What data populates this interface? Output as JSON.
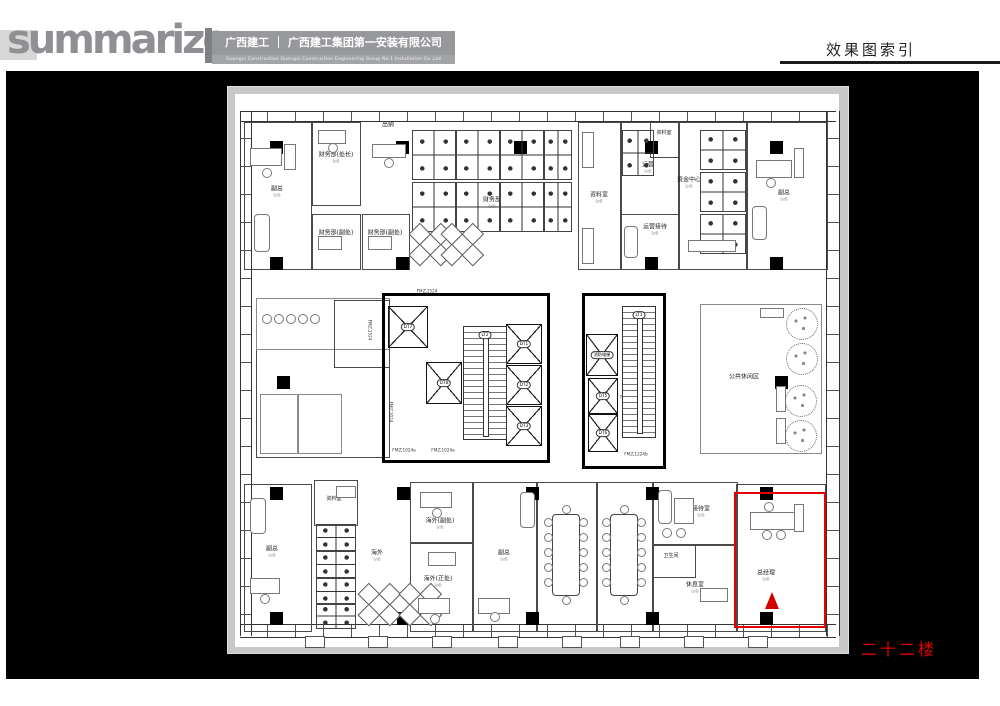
{
  "header": {
    "brand": "summarize",
    "company_cn": "广西建工 ｜ 广西建工集团第一安装有限公司",
    "company_en": "Guangxi Construction      Guangxi Construction Engineering Group No.1 Installation Co.,Ltd",
    "page_title": "效果图索引"
  },
  "footer": {
    "floor_label": "二十二楼"
  },
  "plan": {
    "area_suffix": "(㎡)",
    "highlight_color": "#e60000",
    "rooms": [
      {
        "x": 244,
        "y": 122,
        "w": 66,
        "h": 146
      },
      {
        "x": 312,
        "y": 122,
        "w": 47,
        "h": 82
      },
      {
        "x": 312,
        "y": 214,
        "w": 47,
        "h": 54
      },
      {
        "x": 362,
        "y": 214,
        "w": 46,
        "h": 54
      },
      {
        "x": 578,
        "y": 122,
        "w": 42,
        "h": 146
      },
      {
        "x": 620,
        "y": 122,
        "w": 58,
        "h": 146
      },
      {
        "x": 650,
        "y": 122,
        "w": 28,
        "h": 34
      },
      {
        "x": 620,
        "y": 214,
        "w": 58,
        "h": 54
      },
      {
        "x": 678,
        "y": 122,
        "w": 68,
        "h": 146
      },
      {
        "x": 746,
        "y": 122,
        "w": 80,
        "h": 146
      },
      {
        "x": 256,
        "y": 298,
        "w": 132,
        "h": 158
      },
      {
        "x": 256,
        "y": 298,
        "w": 132,
        "h": 50,
        "k": "thin"
      },
      {
        "x": 334,
        "y": 300,
        "w": 54,
        "h": 66
      },
      {
        "x": 260,
        "y": 394,
        "w": 36,
        "h": 58,
        "k": "thin"
      },
      {
        "x": 298,
        "y": 394,
        "w": 42,
        "h": 58,
        "k": "thin"
      },
      {
        "x": 382,
        "y": 293,
        "w": 162,
        "h": 164,
        "k": "thick"
      },
      {
        "x": 582,
        "y": 293,
        "w": 78,
        "h": 170,
        "k": "thick"
      },
      {
        "x": 700,
        "y": 304,
        "w": 120,
        "h": 148,
        "k": "thin"
      },
      {
        "x": 244,
        "y": 484,
        "w": 66,
        "h": 146
      },
      {
        "x": 314,
        "y": 480,
        "w": 42,
        "h": 44
      },
      {
        "x": 410,
        "y": 482,
        "w": 62,
        "h": 60
      },
      {
        "x": 410,
        "y": 542,
        "w": 62,
        "h": 88
      },
      {
        "x": 472,
        "y": 482,
        "w": 64,
        "h": 148
      },
      {
        "x": 536,
        "y": 482,
        "w": 60,
        "h": 148
      },
      {
        "x": 596,
        "y": 482,
        "w": 56,
        "h": 148
      },
      {
        "x": 652,
        "y": 482,
        "w": 84,
        "h": 62
      },
      {
        "x": 652,
        "y": 544,
        "w": 84,
        "h": 86
      },
      {
        "x": 652,
        "y": 544,
        "w": 42,
        "h": 32
      },
      {
        "x": 736,
        "y": 484,
        "w": 88,
        "h": 146
      }
    ],
    "labels": [
      {
        "t": "副总",
        "x": 277,
        "y": 192,
        "sub": 1,
        "n": "label-vice-gm-1"
      },
      {
        "t": "财务部(处长)",
        "x": 336,
        "y": 158,
        "sub": 1,
        "n": "label-finance-chief"
      },
      {
        "t": "财务部(副处)",
        "x": 336,
        "y": 236,
        "sub": 1,
        "n": "label-finance-deputy-1"
      },
      {
        "t": "财务部(副处)",
        "x": 385,
        "y": 236,
        "sub": 1,
        "n": "label-finance-deputy-2"
      },
      {
        "t": "出纳",
        "x": 388,
        "y": 126,
        "n": "label-cashier"
      },
      {
        "t": "财务部",
        "x": 492,
        "y": 203,
        "sub": 1,
        "n": "label-finance-dept"
      },
      {
        "t": "资料室",
        "x": 599,
        "y": 198,
        "sub": 1,
        "n": "label-archive-1"
      },
      {
        "t": "资料室",
        "x": 664,
        "y": 134,
        "k": "tiny",
        "n": "label-archive-2"
      },
      {
        "t": "运营",
        "x": 648,
        "y": 168,
        "sub": 1,
        "n": "label-operations"
      },
      {
        "t": "运营接待",
        "x": 655,
        "y": 230,
        "sub": 1,
        "n": "label-operations-reception"
      },
      {
        "t": "资金中心",
        "x": 689,
        "y": 183,
        "sub": 1,
        "n": "label-capital-center"
      },
      {
        "t": "副总",
        "x": 784,
        "y": 196,
        "sub": 1,
        "n": "label-vice-gm-2"
      },
      {
        "t": "公共休闲区",
        "x": 744,
        "y": 378,
        "n": "label-public-lounge"
      },
      {
        "t": "副总",
        "x": 272,
        "y": 552,
        "sub": 1,
        "n": "label-vice-gm-3"
      },
      {
        "t": "资料室",
        "x": 334,
        "y": 500,
        "k": "tiny",
        "n": "label-archive-3"
      },
      {
        "t": "海外",
        "x": 377,
        "y": 556,
        "sub": 1,
        "n": "label-overseas"
      },
      {
        "t": "海外(副处)",
        "x": 440,
        "y": 524,
        "sub": 1,
        "n": "label-overseas-deputy"
      },
      {
        "t": "海外(正处)",
        "x": 438,
        "y": 582,
        "sub": 1,
        "n": "label-overseas-chief"
      },
      {
        "t": "副总",
        "x": 504,
        "y": 556,
        "sub": 1,
        "n": "label-vice-gm-4"
      },
      {
        "t": "小会议室",
        "x": 563,
        "y": 562,
        "sub": 1,
        "n": "label-meeting-1"
      },
      {
        "t": "小会议室",
        "x": 621,
        "y": 562,
        "sub": 1,
        "n": "label-meeting-2"
      },
      {
        "t": "接待室",
        "x": 701,
        "y": 512,
        "sub": 1,
        "n": "label-reception-room"
      },
      {
        "t": "卫生间",
        "x": 671,
        "y": 557,
        "k": "tiny",
        "n": "label-washroom"
      },
      {
        "t": "休息室",
        "x": 695,
        "y": 588,
        "sub": 1,
        "n": "label-rest-room"
      },
      {
        "t": "总经理",
        "x": 766,
        "y": 576,
        "sub": 1,
        "n": "label-general-manager"
      },
      {
        "t": "上",
        "x": 474,
        "y": 357,
        "k": "tiny",
        "n": "stair-up-mark"
      },
      {
        "t": "下",
        "x": 495,
        "y": 357,
        "k": "tiny",
        "n": "stair-down-mark"
      },
      {
        "t": "下",
        "x": 632,
        "y": 380,
        "k": "tiny",
        "n": "stair-down-mark"
      },
      {
        "t": "上",
        "x": 650,
        "y": 380,
        "k": "tiny",
        "n": "stair-up-mark"
      },
      {
        "t": "FM乙1524",
        "x": 427,
        "y": 292,
        "k": "tag",
        "n": "door-tag"
      },
      {
        "t": "FM乙1024a",
        "x": 404,
        "y": 451,
        "k": "tag",
        "n": "door-tag"
      },
      {
        "t": "FM乙1024a",
        "x": 443,
        "y": 451,
        "k": "tag",
        "n": "door-tag"
      },
      {
        "t": "FM乙1224b",
        "x": 632,
        "y": 398,
        "k": "tag",
        "n": "door-tag"
      },
      {
        "t": "FM乙1224b",
        "x": 636,
        "y": 455,
        "k": "tag",
        "n": "door-tag"
      },
      {
        "t": "FM乙1524",
        "x": 369,
        "y": 330,
        "k": "tag",
        "rot": 1,
        "n": "door-tag"
      },
      {
        "t": "FM乙1024",
        "x": 390,
        "y": 412,
        "k": "tag",
        "rot": 1,
        "n": "door-tag"
      }
    ],
    "elevators": [
      {
        "l": "DT7",
        "x": 388,
        "y": 306,
        "w": 38,
        "h": 40
      },
      {
        "l": "DT8",
        "x": 426,
        "y": 362,
        "w": 34,
        "h": 40
      },
      {
        "l": "DT1",
        "x": 506,
        "y": 324,
        "w": 34,
        "h": 38
      },
      {
        "l": "DT2",
        "x": 506,
        "y": 365,
        "w": 34,
        "h": 38
      },
      {
        "l": "DT3",
        "x": 506,
        "y": 406,
        "w": 34,
        "h": 38
      },
      {
        "l": "消防电梯",
        "x": 586,
        "y": 334,
        "w": 30,
        "h": 40
      },
      {
        "l": "DT5",
        "x": 588,
        "y": 378,
        "w": 28,
        "h": 34
      },
      {
        "l": "DT6",
        "x": 588,
        "y": 414,
        "w": 28,
        "h": 36
      }
    ],
    "stairs": [
      {
        "l": "LT2",
        "x": 463,
        "y": 326,
        "w": 42,
        "h": 112
      },
      {
        "l": "LT1",
        "x": 622,
        "y": 306,
        "w": 32,
        "h": 130
      }
    ],
    "columns": [
      [
        270,
        141
      ],
      [
        396,
        141
      ],
      [
        514,
        141
      ],
      [
        645,
        141
      ],
      [
        770,
        141
      ],
      [
        270,
        257
      ],
      [
        396,
        257
      ],
      [
        645,
        257
      ],
      [
        770,
        257
      ],
      [
        277,
        376
      ],
      [
        775,
        376
      ],
      [
        270,
        487
      ],
      [
        397,
        487
      ],
      [
        526,
        487
      ],
      [
        646,
        487
      ],
      [
        760,
        487
      ],
      [
        270,
        612
      ],
      [
        397,
        612
      ],
      [
        526,
        612
      ],
      [
        646,
        612
      ],
      [
        760,
        612
      ]
    ],
    "clusters": [
      [
        412,
        130,
        42,
        48
      ],
      [
        456,
        130,
        42,
        48
      ],
      [
        500,
        130,
        42,
        48
      ],
      [
        412,
        182,
        42,
        48
      ],
      [
        456,
        182,
        42,
        48
      ],
      [
        500,
        182,
        42,
        48
      ],
      [
        544,
        130,
        26,
        48
      ],
      [
        544,
        182,
        26,
        48
      ],
      [
        622,
        130,
        30,
        44
      ],
      [
        700,
        130,
        44,
        38
      ],
      [
        700,
        172,
        44,
        38
      ],
      [
        700,
        214,
        44,
        38
      ],
      [
        316,
        524,
        38,
        25
      ],
      [
        316,
        551,
        38,
        25
      ],
      [
        316,
        578,
        38,
        25
      ],
      [
        316,
        603,
        38,
        24
      ]
    ],
    "diamonds": [
      [
        428,
        242,
        30
      ],
      [
        460,
        242,
        30
      ],
      [
        377,
        602,
        30
      ],
      [
        418,
        602,
        30
      ]
    ],
    "meeting_tables": [
      [
        552,
        514,
        26,
        80
      ],
      [
        610,
        514,
        26,
        80
      ]
    ],
    "furniture": [
      [
        250,
        148,
        30,
        16
      ],
      [
        284,
        144,
        10,
        24
      ],
      [
        254,
        214,
        14,
        36,
        4
      ],
      [
        318,
        130,
        26,
        12
      ],
      [
        318,
        236,
        22,
        12
      ],
      [
        368,
        236,
        22,
        12
      ],
      [
        372,
        144,
        32,
        12
      ],
      [
        756,
        160,
        34,
        16
      ],
      [
        794,
        148,
        8,
        28
      ],
      [
        752,
        206,
        13,
        32,
        4
      ],
      [
        688,
        240,
        46,
        10
      ],
      [
        624,
        226,
        12,
        30,
        4
      ],
      [
        582,
        132,
        10,
        34
      ],
      [
        582,
        228,
        10,
        34
      ],
      [
        760,
        308,
        22,
        8
      ],
      [
        776,
        386,
        8,
        24
      ],
      [
        776,
        418,
        8,
        24
      ],
      [
        250,
        498,
        14,
        34,
        4
      ],
      [
        250,
        578,
        28,
        14
      ],
      [
        336,
        486,
        18,
        10
      ],
      [
        420,
        492,
        30,
        14
      ],
      [
        418,
        598,
        30,
        14
      ],
      [
        428,
        552,
        26,
        12
      ],
      [
        520,
        492,
        13,
        34,
        4
      ],
      [
        478,
        598,
        30,
        14
      ],
      [
        658,
        490,
        12,
        32,
        4
      ],
      [
        674,
        498,
        18,
        24
      ],
      [
        750,
        512,
        48,
        16
      ],
      [
        794,
        504,
        8,
        26
      ],
      [
        700,
        588,
        26,
        12
      ]
    ],
    "chairs": [
      [
        266,
        172
      ],
      [
        332,
        147
      ],
      [
        388,
        162
      ],
      [
        770,
        182
      ],
      [
        264,
        598
      ],
      [
        436,
        512
      ],
      [
        434,
        618
      ],
      [
        494,
        616
      ],
      [
        766,
        534
      ],
      [
        780,
        534
      ],
      [
        768,
        506
      ],
      [
        666,
        532
      ],
      [
        680,
        532
      ],
      [
        266,
        318
      ],
      [
        278,
        318
      ],
      [
        290,
        318
      ],
      [
        302,
        318
      ],
      [
        314,
        318
      ]
    ],
    "trees": [
      [
        801,
        323,
        15
      ],
      [
        801,
        358,
        15
      ],
      [
        800,
        400,
        15
      ],
      [
        800,
        435,
        15
      ]
    ],
    "stubs_x": [
      305,
      368,
      432,
      498,
      562,
      620,
      684,
      748
    ],
    "highlight": {
      "x": 734,
      "y": 492,
      "w": 88,
      "h": 132
    },
    "view_arrow": {
      "x": 765,
      "y": 592
    }
  }
}
